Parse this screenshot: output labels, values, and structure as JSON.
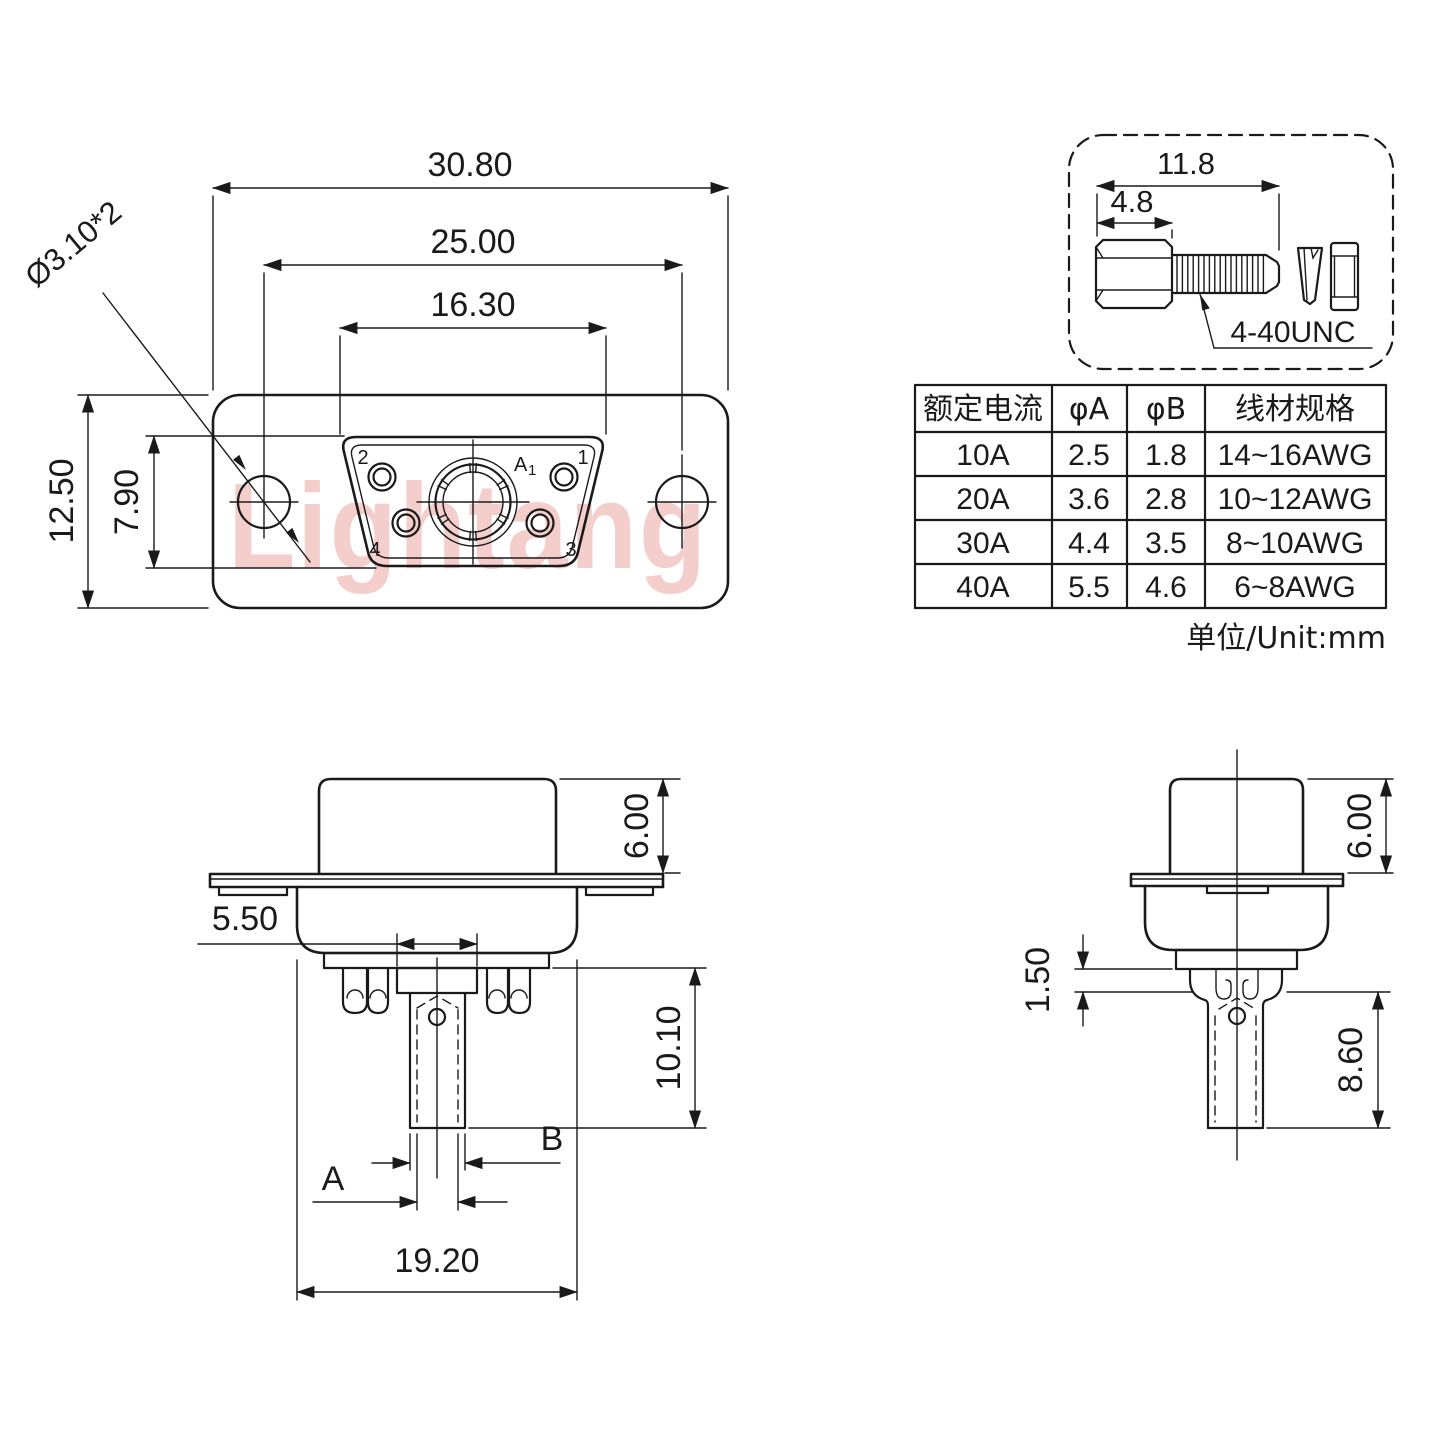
{
  "watermark": {
    "text": "Lightang",
    "color": "#e78c86"
  },
  "front_view": {
    "dim_width": "30.80",
    "dim_hole_spacing": "25.00",
    "dim_insert_width": "16.30",
    "dim_height": "12.50",
    "dim_insert_height": "7.90",
    "dim_hole_note": "Ø3.10*2",
    "pins": {
      "p1": "1",
      "p2": "2",
      "p3": "3",
      "p4": "4",
      "center_letter": "A",
      "center_sub": "1"
    }
  },
  "screw_detail": {
    "dim_total_length": "11.8",
    "dim_head_length": "4.8",
    "thread_label": "4-40UNC"
  },
  "spec_table": {
    "headers": [
      "额定电流",
      "φA",
      "φB",
      "线材规格"
    ],
    "rows": [
      [
        "10A",
        "2.5",
        "1.8",
        "14~16AWG"
      ],
      [
        "20A",
        "3.6",
        "2.8",
        "10~12AWG"
      ],
      [
        "30A",
        "4.4",
        "3.5",
        "8~10AWG"
      ],
      [
        "40A",
        "5.5",
        "4.6",
        "6~8AWG"
      ]
    ],
    "unit_note": "单位/Unit:mm"
  },
  "side_view_front": {
    "dim_shell": "6.00",
    "dim_crimp": "5.50",
    "dim_tail": "10.10",
    "dim_width": "19.20",
    "dim_a": "A",
    "dim_b": "B"
  },
  "side_view_side": {
    "dim_shell": "6.00",
    "dim_step": "1.50",
    "dim_barrel": "8.60"
  }
}
